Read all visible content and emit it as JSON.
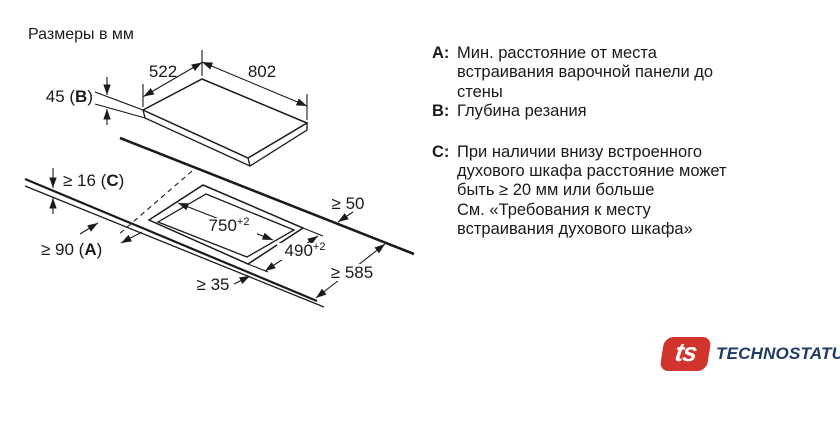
{
  "page": {
    "title": "Размеры в мм"
  },
  "diagram": {
    "panel": {
      "width": "802",
      "depth": "522",
      "height": {
        "prefix": "45 (",
        "letter": "B",
        "suffix": ")"
      }
    },
    "cutout": {
      "width": "750",
      "width_tol": "+2",
      "depth": "490",
      "depth_tol": "+2"
    },
    "clearances": {
      "worktop_thickness": {
        "prefix": "≥ 16 (",
        "letter": "C",
        "suffix": ")"
      },
      "to_wall": {
        "prefix": "≥ 90 (",
        "letter": "A",
        "suffix": ")"
      },
      "front_edge": "≥ 35",
      "rear_edge": "≥ 50",
      "worktop_depth": "≥ 585"
    }
  },
  "legend": {
    "items": [
      {
        "label": "A:",
        "lines": [
          "Мин. расстояние от места",
          "встраивания варочной панели до",
          "стены"
        ]
      },
      {
        "label": "B:",
        "lines": [
          "Глубина резания"
        ]
      },
      {
        "label": "C:",
        "lines": [
          "При наличии внизу встроенного",
          "духового шкафа расстояние может",
          "быть ≥ 20 мм или больше",
          "См. «Требования к месту",
          "встраивания духового шкафа»"
        ]
      }
    ]
  },
  "logo": {
    "badge": "ts",
    "name": "TECHNOSTATUS",
    "badge_color": "#d0342c",
    "name_color": "#1e3a66"
  },
  "colors": {
    "line": "#1a1a1a",
    "background": "#ffffff"
  }
}
